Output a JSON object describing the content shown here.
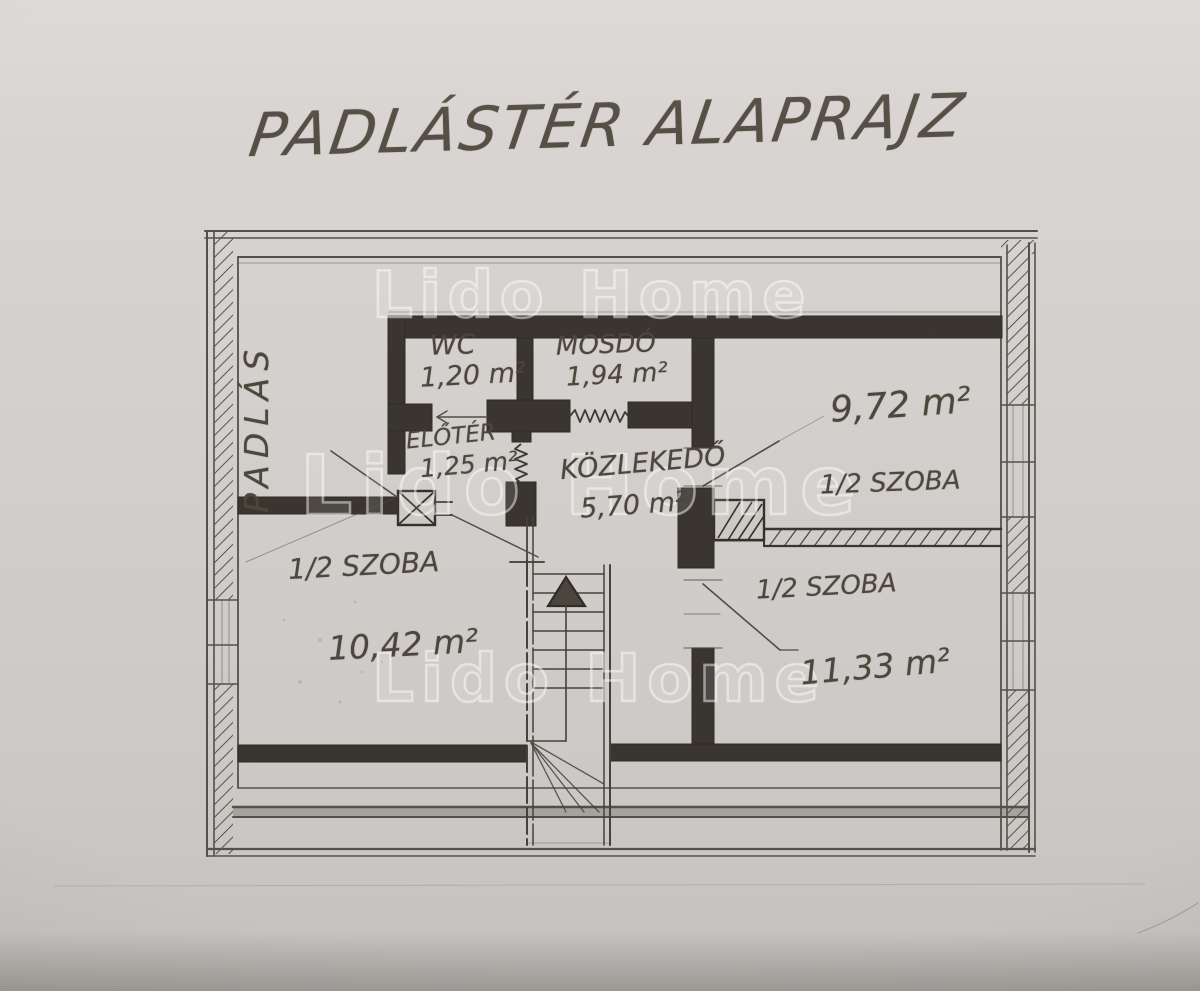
{
  "title": "PADLÁSTÉR ALAPRAJZ",
  "watermark": "Lido Home",
  "floor_plan": {
    "zone_label": "PADLÁS",
    "rooms": [
      {
        "name": "WC",
        "area": "1,20 m²"
      },
      {
        "name": "MOSDÓ",
        "area": "1,94 m²"
      },
      {
        "name": "ELŐTÉR",
        "area": "1,25 m²"
      },
      {
        "name": "KÖZLEKEDŐ",
        "area": "5,70 m²"
      },
      {
        "name": "1/2 SZOBA",
        "area": "9,72 m²"
      },
      {
        "name": "1/2 SZOBA",
        "area": "10,42 m²"
      },
      {
        "name": "1/2 SZOBA",
        "area": "11,33 m²"
      }
    ]
  }
}
